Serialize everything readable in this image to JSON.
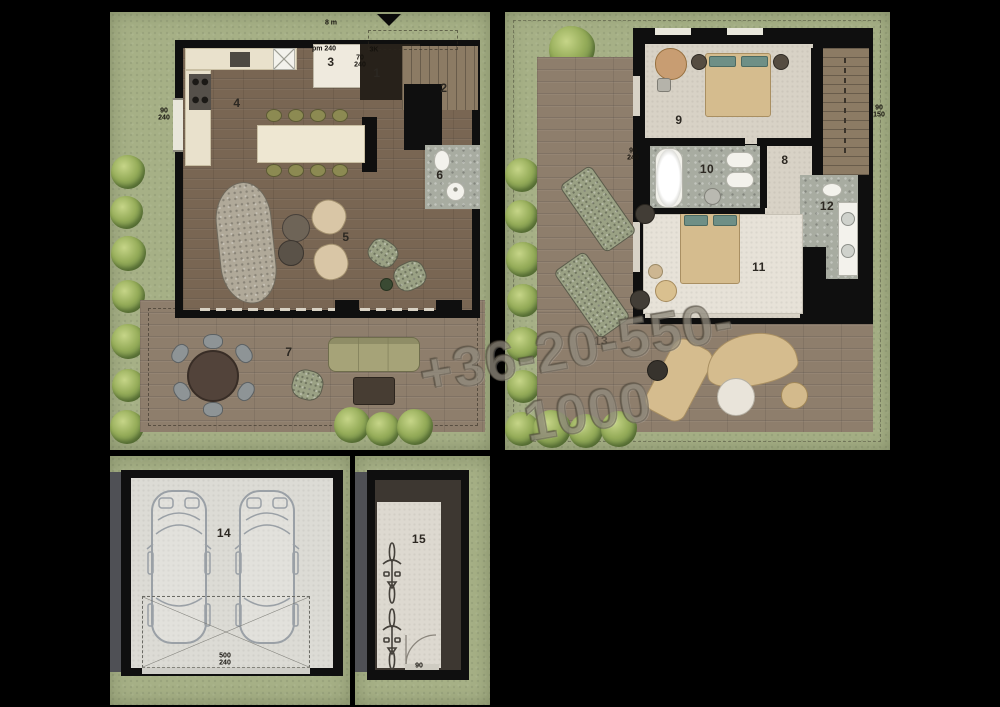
{
  "sheet": {
    "background": "#000000"
  },
  "watermark": {
    "text": "+36-20-550-1000"
  },
  "rooms": [
    {
      "num": "1",
      "x": 377,
      "y": 73
    },
    {
      "num": "2",
      "x": 444,
      "y": 88
    },
    {
      "num": "3",
      "x": 331,
      "y": 62
    },
    {
      "num": "4",
      "x": 237,
      "y": 103
    },
    {
      "num": "5",
      "x": 346,
      "y": 237
    },
    {
      "num": "6",
      "x": 440,
      "y": 175
    },
    {
      "num": "7",
      "x": 289,
      "y": 352
    },
    {
      "num": "8",
      "x": 785,
      "y": 160
    },
    {
      "num": "9",
      "x": 679,
      "y": 120
    },
    {
      "num": "10",
      "x": 707,
      "y": 169
    },
    {
      "num": "11",
      "x": 759,
      "y": 267
    },
    {
      "num": "12",
      "x": 827,
      "y": 206
    },
    {
      "num": "13",
      "x": 601,
      "y": 341,
      "faint": true
    },
    {
      "num": "14",
      "x": 224,
      "y": 533
    },
    {
      "num": "15",
      "x": 419,
      "y": 539
    }
  ],
  "dim_labels": [
    {
      "text": "8 m",
      "x": 331,
      "y": 23
    },
    {
      "text": "90\n240",
      "x": 164,
      "y": 115
    },
    {
      "text": "pm 240",
      "x": 324,
      "y": 49
    },
    {
      "text": "70\n240",
      "x": 360,
      "y": 62
    },
    {
      "text": "3K",
      "x": 374,
      "y": 50
    },
    {
      "text": "90\n240",
      "x": 633,
      "y": 155
    },
    {
      "text": "90\n150",
      "x": 879,
      "y": 112
    },
    {
      "text": "500\n240",
      "x": 225,
      "y": 660
    },
    {
      "text": "90",
      "x": 419,
      "y": 666
    }
  ],
  "palette": {
    "lawn": "#a6b086",
    "deck_wood": "#8e7e6c",
    "interior_wood": "#796653",
    "upper_floor": "#d8d2c6",
    "bath_tile": "#a8aca1",
    "wall": "#0f0f0f",
    "watermark_grey": "#968e7a"
  }
}
